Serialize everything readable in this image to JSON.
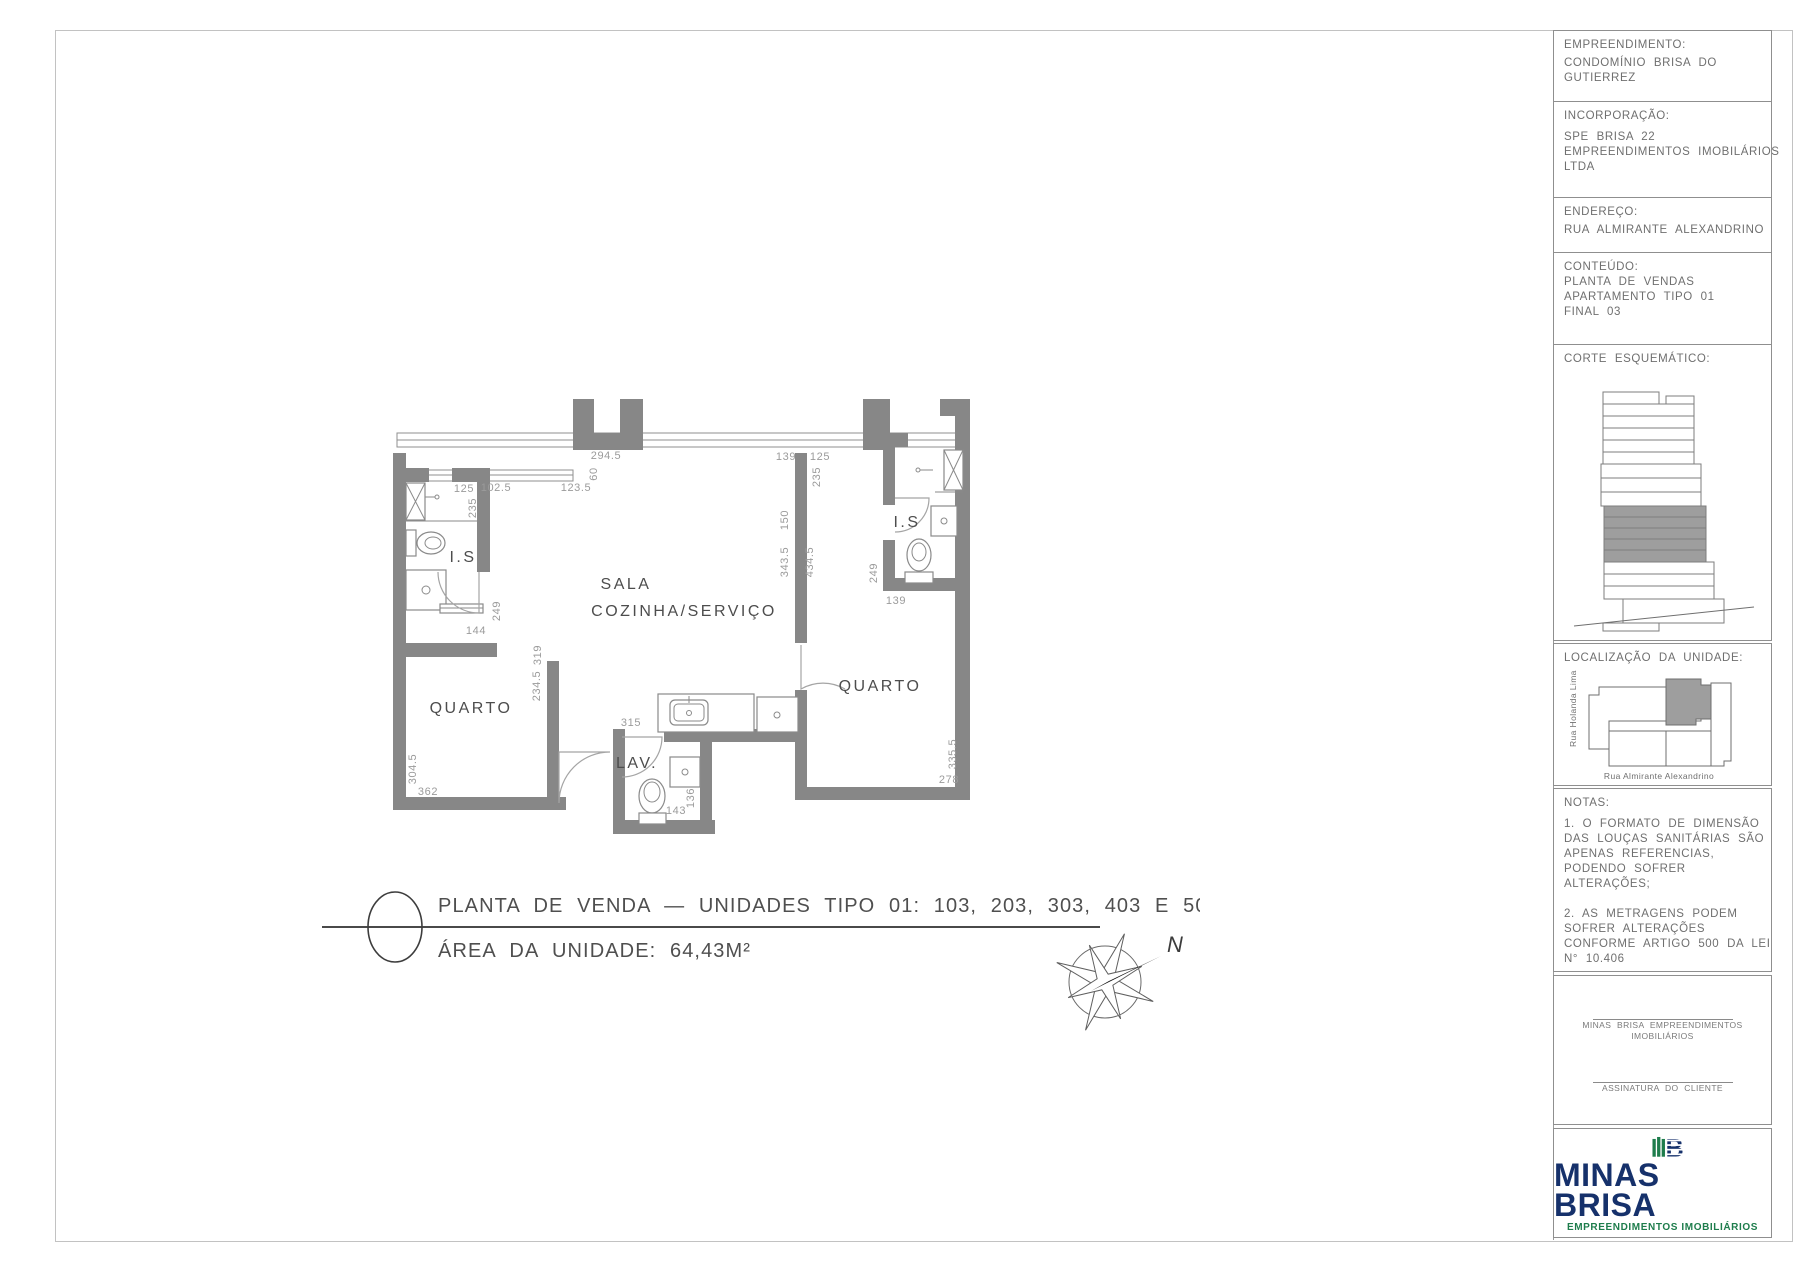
{
  "plan": {
    "rooms": {
      "is_left": "I.S",
      "sala": "SALA",
      "cozinha": "COZINHA/SERVIÇO",
      "quarto_left": "QUARTO",
      "quarto_right": "QUARTO",
      "lav": "LAV.",
      "is_right": "I.S"
    },
    "dims": {
      "d294_5": "294.5",
      "d60": "60",
      "d102_5": "102.5",
      "d123_5": "123.5",
      "d139_tr": "139",
      "d125_r": "125",
      "d235_r": "235",
      "d125_l": "125",
      "d235_l": "235",
      "d249_l": "249",
      "d144": "144",
      "d319": "319",
      "d234_5": "234.5",
      "d150": "150",
      "d343_5": "343.5",
      "d434_5": "434.5",
      "d249_r": "249",
      "d139_br": "139",
      "d315": "315",
      "d304_5": "304.5",
      "d362": "362",
      "d335_5": "335.5",
      "d278": "278",
      "d136": "136",
      "d143": "143"
    },
    "title": {
      "line1": "PLANTA DE VENDA — UNIDADES TIPO 01: 103, 203, 303, 403 E 503",
      "line2": "ÁREA DA UNIDADE: 64,43M²"
    },
    "compass_label": "N"
  },
  "panel": {
    "empreendimento": {
      "title": "EMPREENDIMENTO:",
      "lines": [
        "CONDOMÍNIO BRISA DO",
        "GUTIERREZ"
      ]
    },
    "incorporacao": {
      "title": "INCORPORAÇÃO:",
      "lines": [
        "SPE BRISA 22",
        "EMPREENDIMENTOS IMOBILÁRIOS",
        "LTDA"
      ]
    },
    "endereco": {
      "title": "ENDEREÇO:",
      "lines": [
        "RUA ALMIRANTE ALEXANDRINO"
      ]
    },
    "conteudo": {
      "title": "CONTEÚDO:",
      "lines": [
        "PLANTA DE VENDAS",
        "APARTAMENTO TIPO 01",
        "FINAL 03"
      ]
    },
    "corte": {
      "title": "CORTE ESQUEMÁTICO:"
    },
    "localizacao": {
      "title": "LOCALIZAÇÃO DA UNIDADE:",
      "street_left": "Rua Holanda Lima",
      "street_bottom": "Rua Almirante Alexandrino"
    },
    "notas": {
      "title": "NOTAS:",
      "note1": [
        "1. O FORMATO DE DIMENSÃO",
        "DAS LOUÇAS SANITÁRIAS SÃO",
        "APENAS REFERENCIAS,",
        "PODENDO SOFRER",
        "ALTERAÇÕES;"
      ],
      "note2": [
        "2. AS METRAGENS PODEM",
        "SOFRER ALTERAÇÕES",
        "CONFORME ARTIGO 500 DA LEI",
        "N° 10.406"
      ]
    },
    "assinatura": {
      "company": [
        "MINAS BRISA EMPREENDIMENTOS",
        "IMOBILIÁRIOS"
      ],
      "client": "ASSINATURA DO CLIENTE"
    },
    "logo": {
      "name": "MINAS BRISA",
      "tagline": "EMPREENDIMENTOS IMOBILIÁRIOS",
      "letter": "B"
    }
  },
  "colors": {
    "wall_gray": "#878787",
    "highlight_gray": "#9e9e9e",
    "logo_green": "#1e7d4c",
    "logo_navy": "#16316b"
  }
}
